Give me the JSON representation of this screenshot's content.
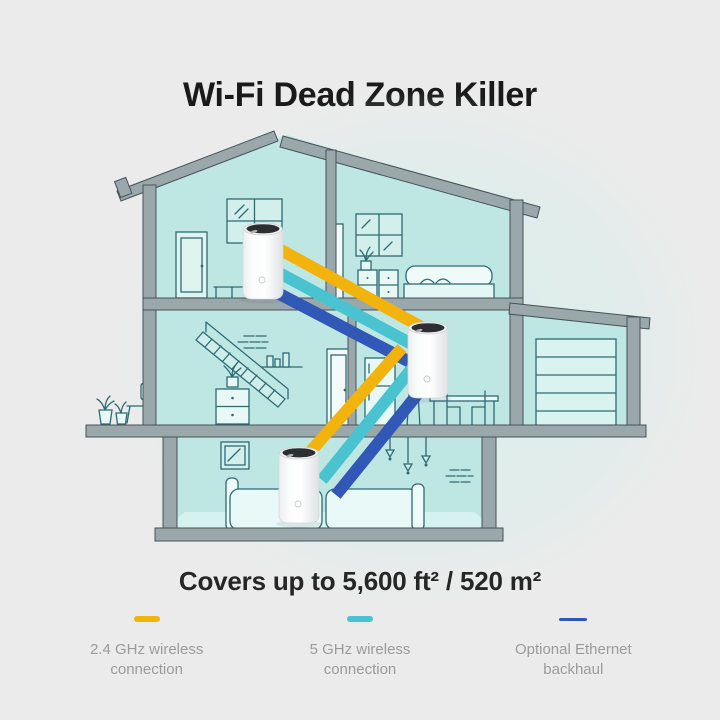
{
  "page": {
    "background": "#EBEBEB"
  },
  "header": {
    "title": "Wi-Fi Dead Zone Killer"
  },
  "coverage": {
    "text": "Covers up to 5,600 ft² / 520 m²"
  },
  "legend": {
    "items": [
      {
        "name": "2-4ghz-wireless",
        "line1": "2.4 GHz wireless",
        "line2": "connection"
      },
      {
        "name": "5ghz-wireless",
        "line1": "5 GHz wireless",
        "line2": "connection"
      },
      {
        "name": "ethernet-backhaul",
        "line1": "Optional Ethernet",
        "line2": "backhaul"
      }
    ]
  },
  "illustration": {
    "devices": [
      {
        "name": "deco-unit-upstairs"
      },
      {
        "name": "deco-unit-main-floor"
      },
      {
        "name": "deco-unit-living-room"
      }
    ],
    "colors": {
      "wifi24": "#F2B30D",
      "wifi5": "#49C3D0",
      "ethernet": "#3158B7",
      "room": "#BEE7E4",
      "room-light": "#D6F2EF",
      "line": "#2E6B74",
      "struct": "#9BA8AB",
      "struct-edge": "#45525A",
      "glow": "#D9EEEB",
      "background": "#EBEBEB",
      "device-top": "#2C2E31"
    }
  }
}
